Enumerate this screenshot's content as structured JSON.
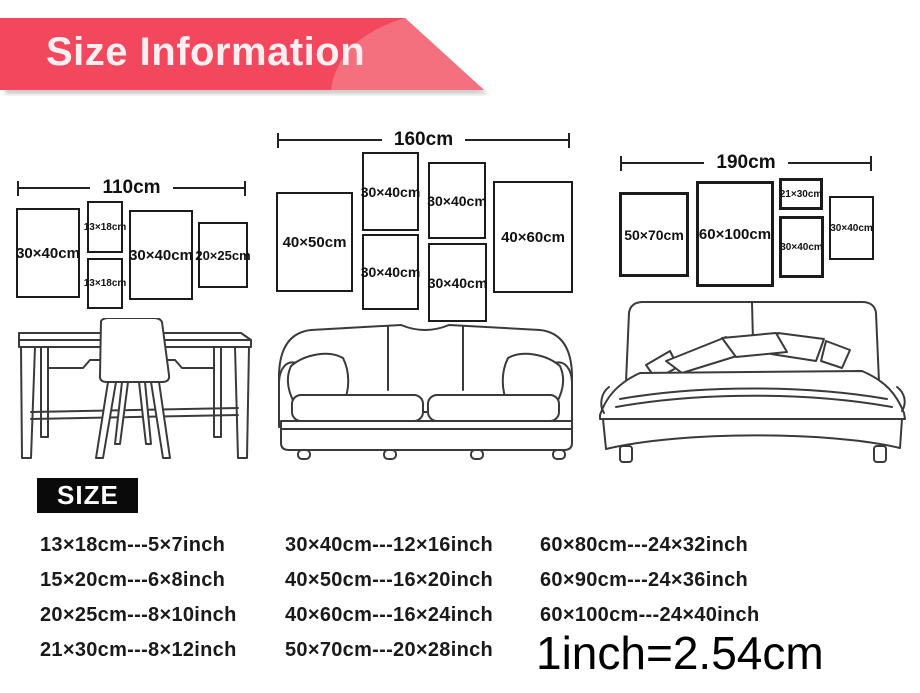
{
  "banner": {
    "title": "Size Information"
  },
  "colors": {
    "ribbon": "#f2475d",
    "ribbon-light": "#f5707f",
    "banner-text": "#fdeef1",
    "badge-bg": "#0a0a0a",
    "ink": "#1a1a1a",
    "line-art": "#3a3a3a"
  },
  "wall_groups": [
    {
      "dimension": "110cm",
      "frames": [
        {
          "label": "30×40cm"
        },
        {
          "label": "13×18cm"
        },
        {
          "label": "13×18cm"
        },
        {
          "label": "30×40cm"
        },
        {
          "label": "20×25cm"
        }
      ]
    },
    {
      "dimension": "160cm",
      "frames": [
        {
          "label": "40×50cm"
        },
        {
          "label": "30×40cm"
        },
        {
          "label": "30×40cm"
        },
        {
          "label": "30×40cm"
        },
        {
          "label": "30×40cm"
        },
        {
          "label": "40×60cm"
        }
      ]
    },
    {
      "dimension": "190cm",
      "frames": [
        {
          "label": "50×70cm"
        },
        {
          "label": "60×100cm"
        },
        {
          "label": "21×30cm"
        },
        {
          "label": "30×40cm"
        },
        {
          "label": "30×40cm"
        }
      ]
    }
  ],
  "furniture": [
    {
      "icon": "desk-with-chair-illustration"
    },
    {
      "icon": "sofa-illustration"
    },
    {
      "icon": "double-bed-illustration"
    }
  ],
  "size_section": {
    "heading": "SIZE"
  },
  "conversion": {
    "columns": [
      [
        "13×18cm---5×7inch",
        "15×20cm---6×8inch",
        "20×25cm---8×10inch",
        "21×30cm---8×12inch"
      ],
      [
        "30×40cm---12×16inch",
        "40×50cm---16×20inch",
        "40×60cm---16×24inch",
        "50×70cm---20×28inch"
      ],
      [
        "60×80cm---24×32inch",
        "60×90cm---24×36inch",
        "60×100cm---24×40inch"
      ]
    ],
    "note": "1inch=2.54cm"
  }
}
